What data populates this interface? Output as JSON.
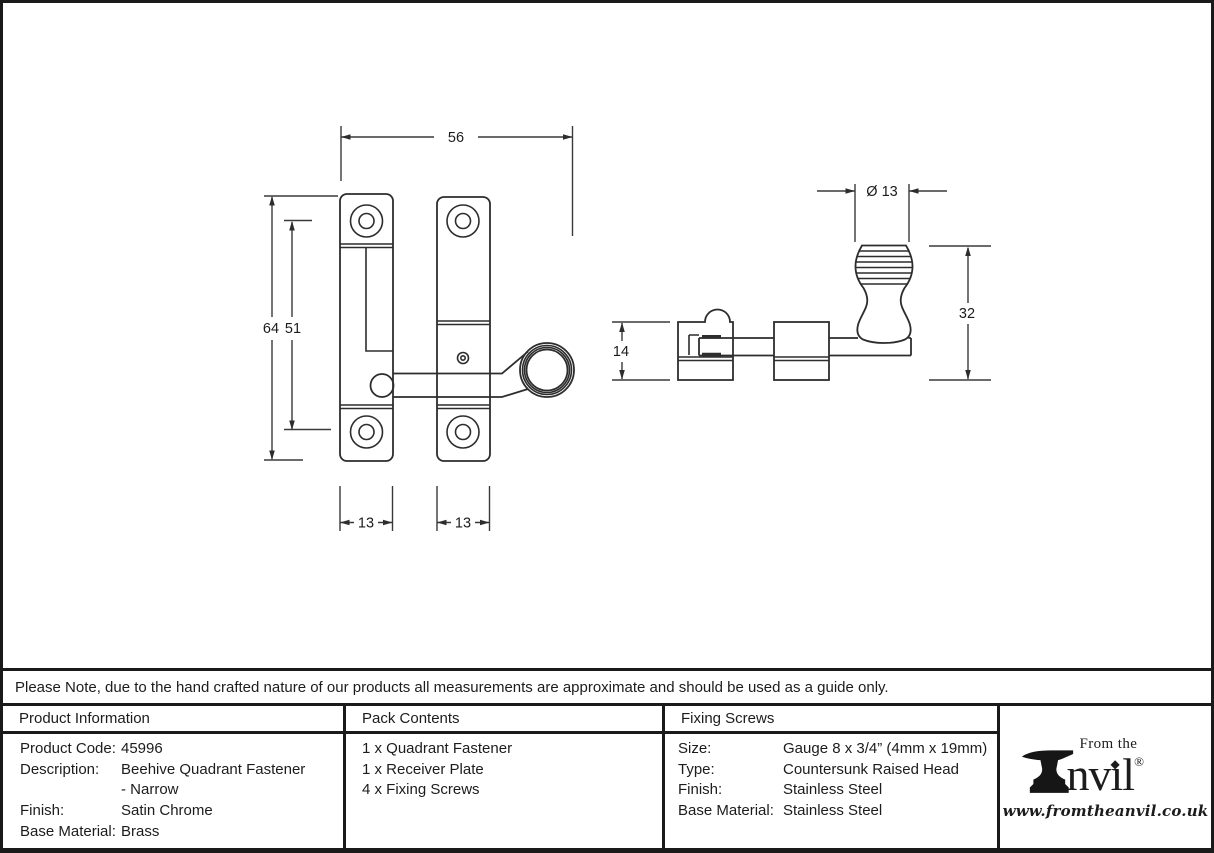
{
  "drawing": {
    "front_view": {
      "overall_width": "56",
      "overall_height": "64",
      "screw_spacing": "51",
      "left_plate_width": "13",
      "right_plate_width": "13"
    },
    "side_view": {
      "knob_diameter": "Ø 13",
      "plate_height": "14",
      "overall_projection": "32"
    }
  },
  "note": "Please Note, due to the hand crafted nature of our products all measurements are approximate and should be used as a guide only.",
  "product_information": {
    "header": "Product Information",
    "rows": [
      {
        "label": "Product Code:",
        "value": "45996"
      },
      {
        "label": "Description:",
        "value": "Beehive Quadrant Fastener"
      },
      {
        "label": "",
        "value": "- Narrow"
      },
      {
        "label": "Finish:",
        "value": "Satin Chrome"
      },
      {
        "label": "Base Material:",
        "value": "Brass"
      }
    ]
  },
  "pack_contents": {
    "header": "Pack Contents",
    "items": [
      "1 x Quadrant Fastener",
      "1 x Receiver Plate",
      "4 x Fixing Screws"
    ]
  },
  "fixing_screws": {
    "header": "Fixing Screws",
    "rows": [
      {
        "label": "Size:",
        "value": "Gauge 8 x 3/4” (4mm x 19mm)"
      },
      {
        "label": "Type:",
        "value": "Countersunk Raised Head"
      },
      {
        "label": "Finish:",
        "value": "Stainless Steel"
      },
      {
        "label": "Base Material:",
        "value": "Stainless Steel"
      }
    ]
  },
  "logo": {
    "prefix": "From the",
    "name_start": "nv",
    "name_i": "ı",
    "name_end": "l",
    "tittle": "◆",
    "registered": "®",
    "url": "www.fromtheanvil.co.uk"
  },
  "colors": {
    "line": "#2d2d2d",
    "border": "#1a1a1a",
    "background": "#ffffff"
  }
}
